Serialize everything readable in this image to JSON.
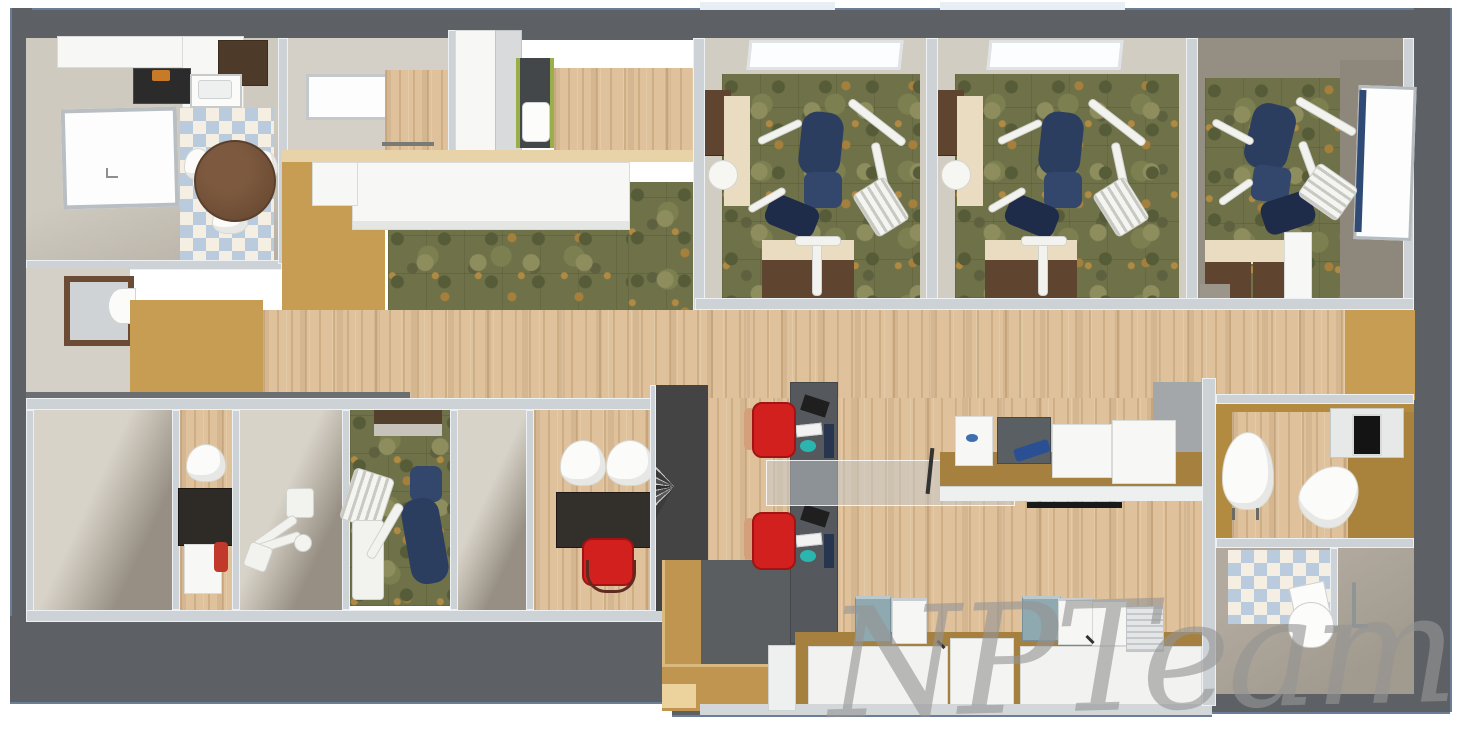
{
  "watermark": {
    "text": "NPTeam"
  },
  "palette": {
    "shell": "#5d6165",
    "wall": "#cdd2d6",
    "beigeWall": "#d5d0c7",
    "gold": "#c79d54",
    "goldDeep": "#a9823c",
    "cream": "#e9dcc0",
    "woodLight": "#dfc29c",
    "camoBase": "#6f7148",
    "tileBlue": "#b9cbdc",
    "tileCream": "#f4eee3",
    "cabinetBrown": "#5f452f",
    "navy": "#2c3e60",
    "red": "#d2201f",
    "teal": "#8fa9b1"
  }
}
